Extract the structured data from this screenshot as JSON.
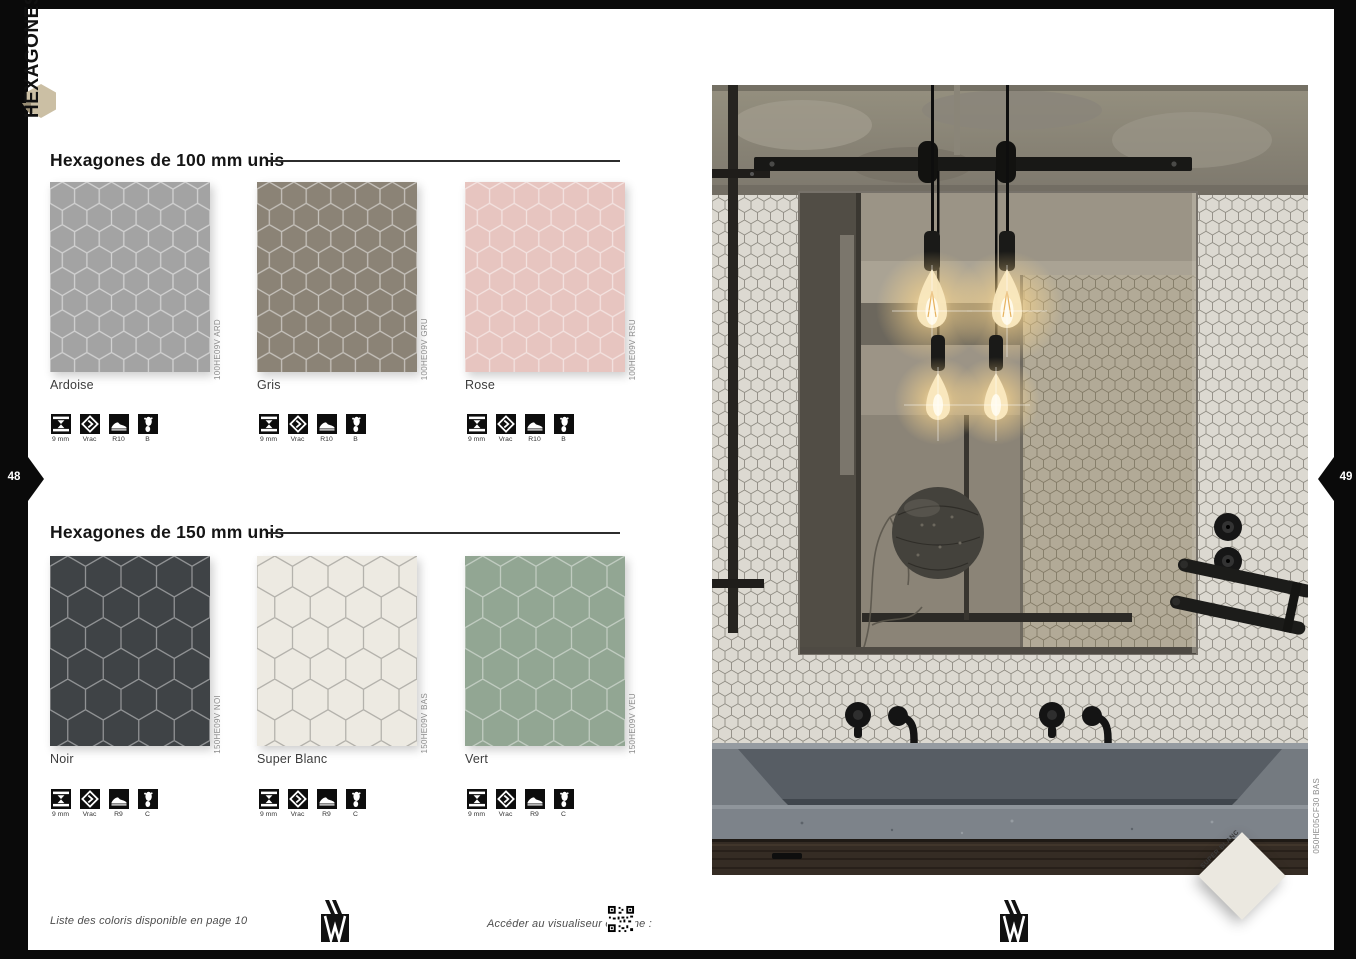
{
  "page": {
    "category_tab": "HEXAGONES",
    "left_page_number": "48",
    "right_page_number": "49",
    "accent_hex_color": "#cbbfa4"
  },
  "sections": [
    {
      "title": "Hexagones de 100 mm unis",
      "swatches": [
        {
          "name": "Ardoise",
          "code": "100HE09V ARD",
          "bg": "#a3a3a3",
          "line": "#bcbcbc"
        },
        {
          "name": "Gris",
          "code": "100HE09V GRU",
          "bg": "#8b8376",
          "line": "#a79f92"
        },
        {
          "name": "Rose",
          "code": "100HE09V RSU",
          "bg": "#e7c5c0",
          "line": "#f2dcd8"
        }
      ],
      "specs": [
        {
          "icon": "thickness-icon",
          "label": "9 mm"
        },
        {
          "icon": "bulk-icon",
          "label": "Vrac"
        },
        {
          "icon": "slip-shoe-icon",
          "label": "R10"
        },
        {
          "icon": "barefoot-icon",
          "label": "B"
        }
      ]
    },
    {
      "title": "Hexagones de 150 mm unis",
      "swatches": [
        {
          "name": "Noir",
          "code": "150HE09V NOI",
          "bg": "#3f4346",
          "line": "#6d7174"
        },
        {
          "name": "Super Blanc",
          "code": "150HE09V BAS",
          "bg": "#edeae2",
          "line": "#b1ada3"
        },
        {
          "name": "Vert",
          "code": "150HE09V VEU",
          "bg": "#92a693",
          "line": "#b7c4b6"
        }
      ],
      "specs": [
        {
          "icon": "thickness-icon",
          "label": "9 mm"
        },
        {
          "icon": "bulk-icon",
          "label": "Vrac"
        },
        {
          "icon": "slip-shoe-icon",
          "label": "R9"
        },
        {
          "icon": "barefoot-icon",
          "label": "C"
        }
      ]
    }
  ],
  "footer": {
    "left_note": "Liste des coloris disponible en page 10",
    "visualizer_label": "Accéder au visualiseur en ligne :"
  },
  "photo": {
    "code": "050HE05CF30 BAS",
    "diamond_label": "SUPER BLANC"
  }
}
